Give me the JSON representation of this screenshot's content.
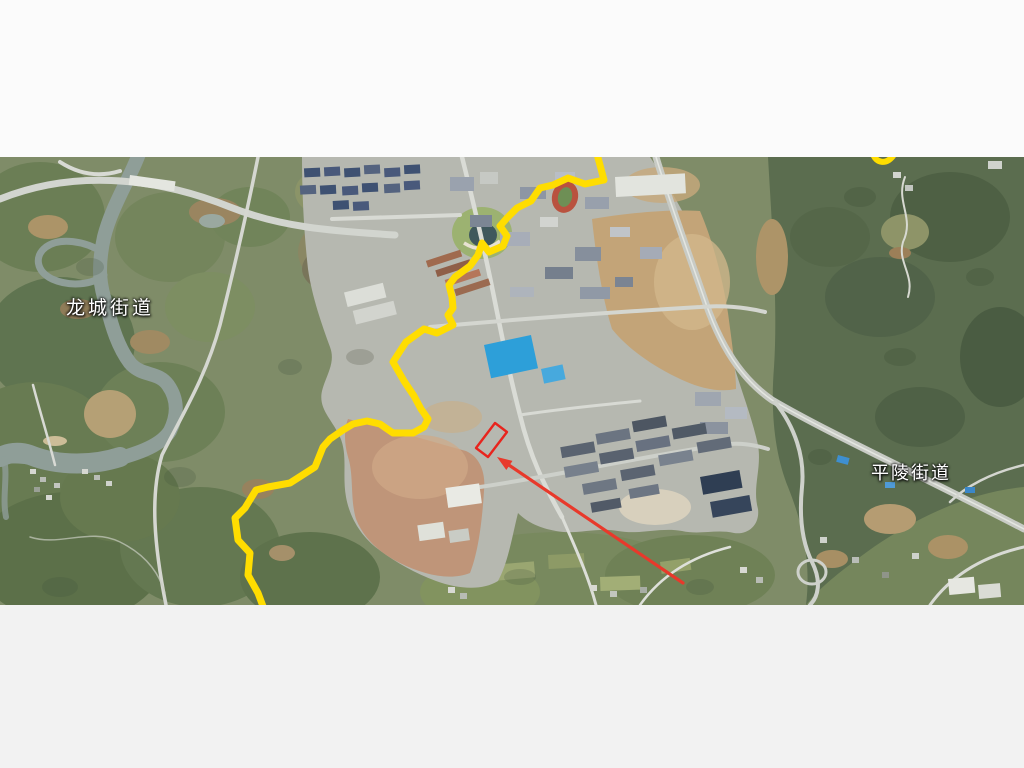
{
  "page": {
    "letterbox_top_color": "#fbfbfb",
    "letterbox_bottom_color": "#f2f2f2"
  },
  "map": {
    "kind": "satellite-imagery",
    "labels": {
      "longcheng": "龙城街道",
      "pingling": "平陵街道"
    },
    "annotations": {
      "boundary_color": "#ffdd00",
      "marker_color": "#e8241d",
      "arrow_color": "#e8392b"
    }
  }
}
